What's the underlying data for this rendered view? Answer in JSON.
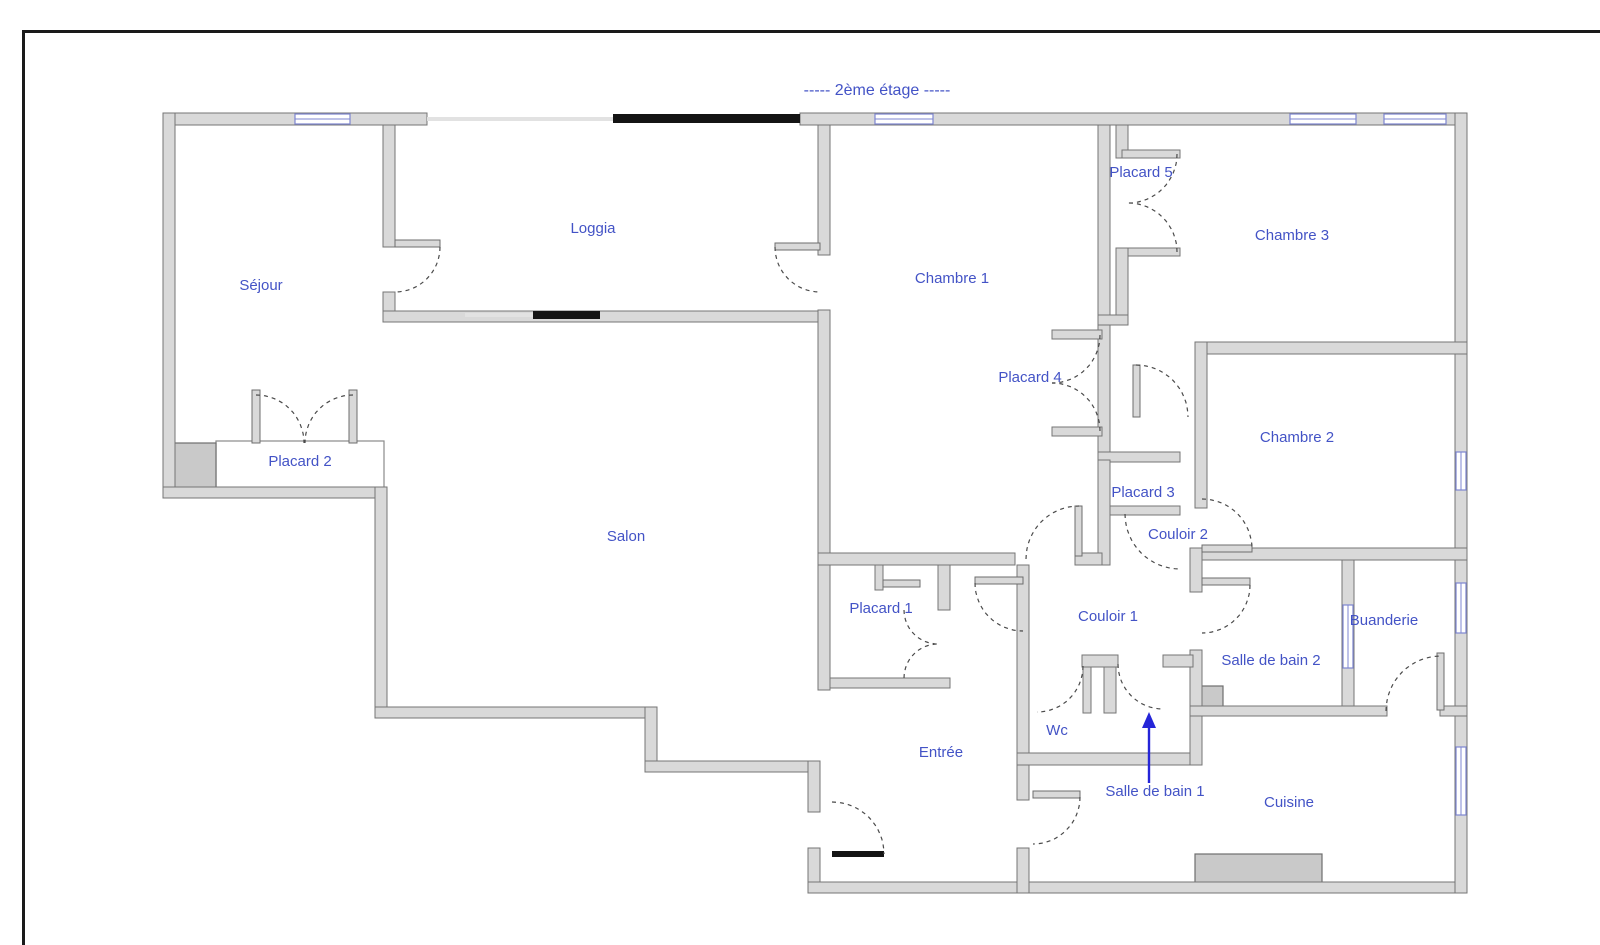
{
  "title": {
    "text": "-----  2ème étage  -----",
    "x": 877,
    "y": 95
  },
  "colors": {
    "label_blue": "#4353c6",
    "wall_gray": "#d9d9d9",
    "wall_edge": "#757575",
    "window_blue": "#7d86d0",
    "arrow_blue": "#2525d8",
    "opening_black": "#141414"
  },
  "rooms": [
    {
      "id": "sejour",
      "label": "Séjour",
      "x": 261,
      "y": 290
    },
    {
      "id": "loggia",
      "label": "Loggia",
      "x": 593,
      "y": 233
    },
    {
      "id": "chambre1",
      "label": "Chambre 1",
      "x": 952,
      "y": 283
    },
    {
      "id": "placard5",
      "label": "Placard 5",
      "x": 1141,
      "y": 177
    },
    {
      "id": "chambre3",
      "label": "Chambre 3",
      "x": 1292,
      "y": 240
    },
    {
      "id": "placard4",
      "label": "Placard 4",
      "x": 1030,
      "y": 382
    },
    {
      "id": "chambre2",
      "label": "Chambre 2",
      "x": 1297,
      "y": 442
    },
    {
      "id": "placard2",
      "label": "Placard 2",
      "x": 300,
      "y": 466
    },
    {
      "id": "placard3",
      "label": "Placard 3",
      "x": 1143,
      "y": 497
    },
    {
      "id": "couloir2",
      "label": "Couloir 2",
      "x": 1178,
      "y": 539
    },
    {
      "id": "salon",
      "label": "Salon",
      "x": 626,
      "y": 541
    },
    {
      "id": "placard1",
      "label": "Placard 1",
      "x": 881,
      "y": 613
    },
    {
      "id": "couloir1",
      "label": "Couloir 1",
      "x": 1108,
      "y": 621
    },
    {
      "id": "sdb2",
      "label": "Salle de bain 2",
      "x": 1271,
      "y": 665
    },
    {
      "id": "buanderie",
      "label": "Buanderie",
      "x": 1384,
      "y": 625
    },
    {
      "id": "wc",
      "label": "Wc",
      "x": 1057,
      "y": 735
    },
    {
      "id": "entree",
      "label": "Entrée",
      "x": 941,
      "y": 757
    },
    {
      "id": "sdb1",
      "label": "Salle de bain 1",
      "x": 1155,
      "y": 796
    },
    {
      "id": "cuisine",
      "label": "Cuisine",
      "x": 1289,
      "y": 807
    }
  ],
  "plan": {
    "border": [
      [
        22,
        30,
        1578,
        3
      ],
      [
        22,
        30,
        3,
        915
      ]
    ],
    "walls": [
      [
        163,
        113,
        264,
        12
      ],
      [
        800,
        113,
        667,
        12
      ],
      [
        163,
        113,
        12,
        385
      ],
      [
        163,
        487,
        224,
        11
      ],
      [
        375,
        487,
        12,
        231
      ],
      [
        375,
        707,
        282,
        11
      ],
      [
        645,
        707,
        12,
        65
      ],
      [
        645,
        761,
        175,
        11
      ],
      [
        808,
        761,
        12,
        51
      ],
      [
        808,
        848,
        12,
        45
      ],
      [
        808,
        882,
        659,
        11
      ],
      [
        1455,
        113,
        12,
        780
      ],
      [
        383,
        125,
        12,
        122
      ],
      [
        383,
        292,
        12,
        30
      ],
      [
        383,
        311,
        440,
        11
      ],
      [
        818,
        125,
        12,
        130
      ],
      [
        818,
        310,
        12,
        380
      ],
      [
        1098,
        125,
        12,
        190
      ],
      [
        1116,
        125,
        12,
        33
      ],
      [
        1122,
        150,
        58,
        8
      ],
      [
        1122,
        248,
        58,
        8
      ],
      [
        1116,
        248,
        12,
        67
      ],
      [
        1098,
        315,
        30,
        10
      ],
      [
        1098,
        325,
        12,
        135
      ],
      [
        1052,
        330,
        50,
        9
      ],
      [
        1052,
        427,
        50,
        9
      ],
      [
        1098,
        452,
        82,
        10
      ],
      [
        1098,
        460,
        12,
        105
      ],
      [
        1110,
        506,
        70,
        9
      ],
      [
        1195,
        342,
        272,
        12
      ],
      [
        1195,
        342,
        12,
        166
      ],
      [
        1190,
        548,
        277,
        12
      ],
      [
        1190,
        548,
        12,
        44
      ],
      [
        1190,
        650,
        12,
        115
      ],
      [
        1342,
        560,
        12,
        156
      ],
      [
        1190,
        706,
        197,
        10
      ],
      [
        1440,
        706,
        27,
        10
      ],
      [
        818,
        553,
        197,
        12
      ],
      [
        1075,
        553,
        27,
        12
      ],
      [
        938,
        565,
        12,
        45
      ],
      [
        875,
        565,
        8,
        25
      ],
      [
        830,
        678,
        120,
        10
      ],
      [
        1017,
        565,
        12,
        235
      ],
      [
        1017,
        848,
        12,
        45
      ],
      [
        1082,
        655,
        36,
        12
      ],
      [
        1163,
        655,
        30,
        12
      ],
      [
        1083,
        667,
        8,
        46
      ],
      [
        1104,
        667,
        12,
        46
      ],
      [
        1017,
        753,
        173,
        12
      ]
    ],
    "leaves": [
      [
        395,
        240,
        45,
        7
      ],
      [
        775,
        243,
        45,
        7
      ],
      [
        252,
        390,
        8,
        53
      ],
      [
        349,
        390,
        8,
        53
      ],
      [
        1133,
        365,
        7,
        52
      ],
      [
        1202,
        545,
        50,
        7
      ],
      [
        1202,
        578,
        48,
        7
      ],
      [
        1437,
        653,
        7,
        57
      ],
      [
        1075,
        506,
        7,
        50
      ],
      [
        975,
        577,
        48,
        7
      ],
      [
        1033,
        791,
        47,
        7
      ],
      [
        883,
        580,
        37,
        7
      ]
    ],
    "black_leaves": [
      [
        832,
        851,
        52,
        6
      ]
    ],
    "arcs": [
      [
        395,
        247,
        45,
        0,
        90
      ],
      [
        820,
        247,
        45,
        180,
        90
      ],
      [
        256,
        443,
        48,
        270,
        360
      ],
      [
        353,
        443,
        48,
        270,
        180
      ],
      [
        1128,
        154,
        49,
        0,
        90
      ],
      [
        1128,
        252,
        49,
        0,
        -90
      ],
      [
        1052,
        335,
        48,
        0,
        90
      ],
      [
        1052,
        431,
        48,
        0,
        -90
      ],
      [
        1136,
        417,
        52,
        270,
        360
      ],
      [
        1180,
        514,
        55,
        180,
        90
      ],
      [
        1202,
        549,
        50,
        270,
        360
      ],
      [
        1202,
        585,
        48,
        0,
        90
      ],
      [
        1441,
        711,
        55,
        180,
        270
      ],
      [
        1079,
        559,
        53,
        180,
        270
      ],
      [
        1023,
        583,
        48,
        180,
        90
      ],
      [
        1037,
        666,
        46,
        0,
        90
      ],
      [
        1163,
        664,
        45,
        180,
        90
      ],
      [
        1033,
        797,
        47,
        0,
        90
      ],
      [
        832,
        854,
        52,
        270,
        360
      ],
      [
        938,
        610,
        34,
        180,
        90
      ],
      [
        938,
        678,
        34,
        180,
        270
      ]
    ],
    "windows": [
      [
        295,
        114,
        55,
        10
      ],
      [
        875,
        114,
        58,
        10
      ],
      [
        1290,
        114,
        66,
        10
      ],
      [
        1384,
        114,
        62,
        10
      ],
      [
        1456,
        452,
        10,
        38
      ],
      [
        1456,
        583,
        10,
        50
      ],
      [
        1456,
        747,
        10,
        68
      ],
      [
        1343,
        605,
        10,
        63
      ]
    ],
    "black_segments": [
      [
        613,
        114,
        187,
        9
      ],
      [
        533,
        311,
        67,
        8
      ]
    ],
    "light_segments": [
      [
        427,
        117,
        186,
        4
      ],
      [
        465,
        313,
        68,
        4
      ]
    ],
    "gray_boxes": [
      [
        169,
        443,
        47,
        45
      ],
      [
        1199,
        686,
        24,
        24
      ],
      [
        1195,
        854,
        127,
        30
      ]
    ],
    "white_boxes": [
      [
        216,
        441,
        168,
        48
      ]
    ],
    "arrow": {
      "x": 1149,
      "y_from": 783,
      "y_to": 716
    }
  }
}
